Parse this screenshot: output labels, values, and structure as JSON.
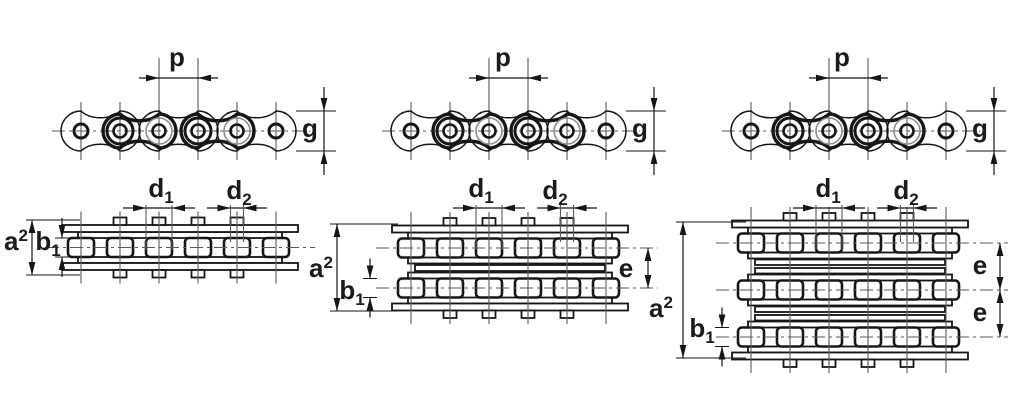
{
  "diagram": {
    "kind": "technical drawing",
    "subject": "Roller chain dimensioning - simplex, duplex and triplex strands",
    "figures": [
      {
        "name": "simplex chain",
        "strands": 1,
        "views": [
          "side view",
          "plan view"
        ],
        "dimensions": [
          "p",
          "g",
          "d1",
          "d2",
          "a2",
          "b1"
        ]
      },
      {
        "name": "duplex chain",
        "strands": 2,
        "views": [
          "side view",
          "plan view"
        ],
        "dimensions": [
          "p",
          "g",
          "d1",
          "d2",
          "a2",
          "b1",
          "e"
        ]
      },
      {
        "name": "triplex chain",
        "strands": 3,
        "views": [
          "side view",
          "plan view"
        ],
        "dimensions": [
          "p",
          "g",
          "d1",
          "d2",
          "a2",
          "b1",
          "e",
          "e"
        ]
      }
    ]
  },
  "labels": {
    "p": "p",
    "g": "g",
    "e": "e",
    "d1": {
      "base": "d",
      "sub": "1"
    },
    "d2": {
      "base": "d",
      "sub": "2"
    },
    "a2": {
      "base": "a",
      "sup": "2"
    },
    "b1": {
      "base": "b",
      "sub": "1"
    }
  },
  "colors": {
    "background": "#ffffff",
    "line": "#161616",
    "centerline": "#5a5a5a",
    "label": "#1b1b1b"
  }
}
